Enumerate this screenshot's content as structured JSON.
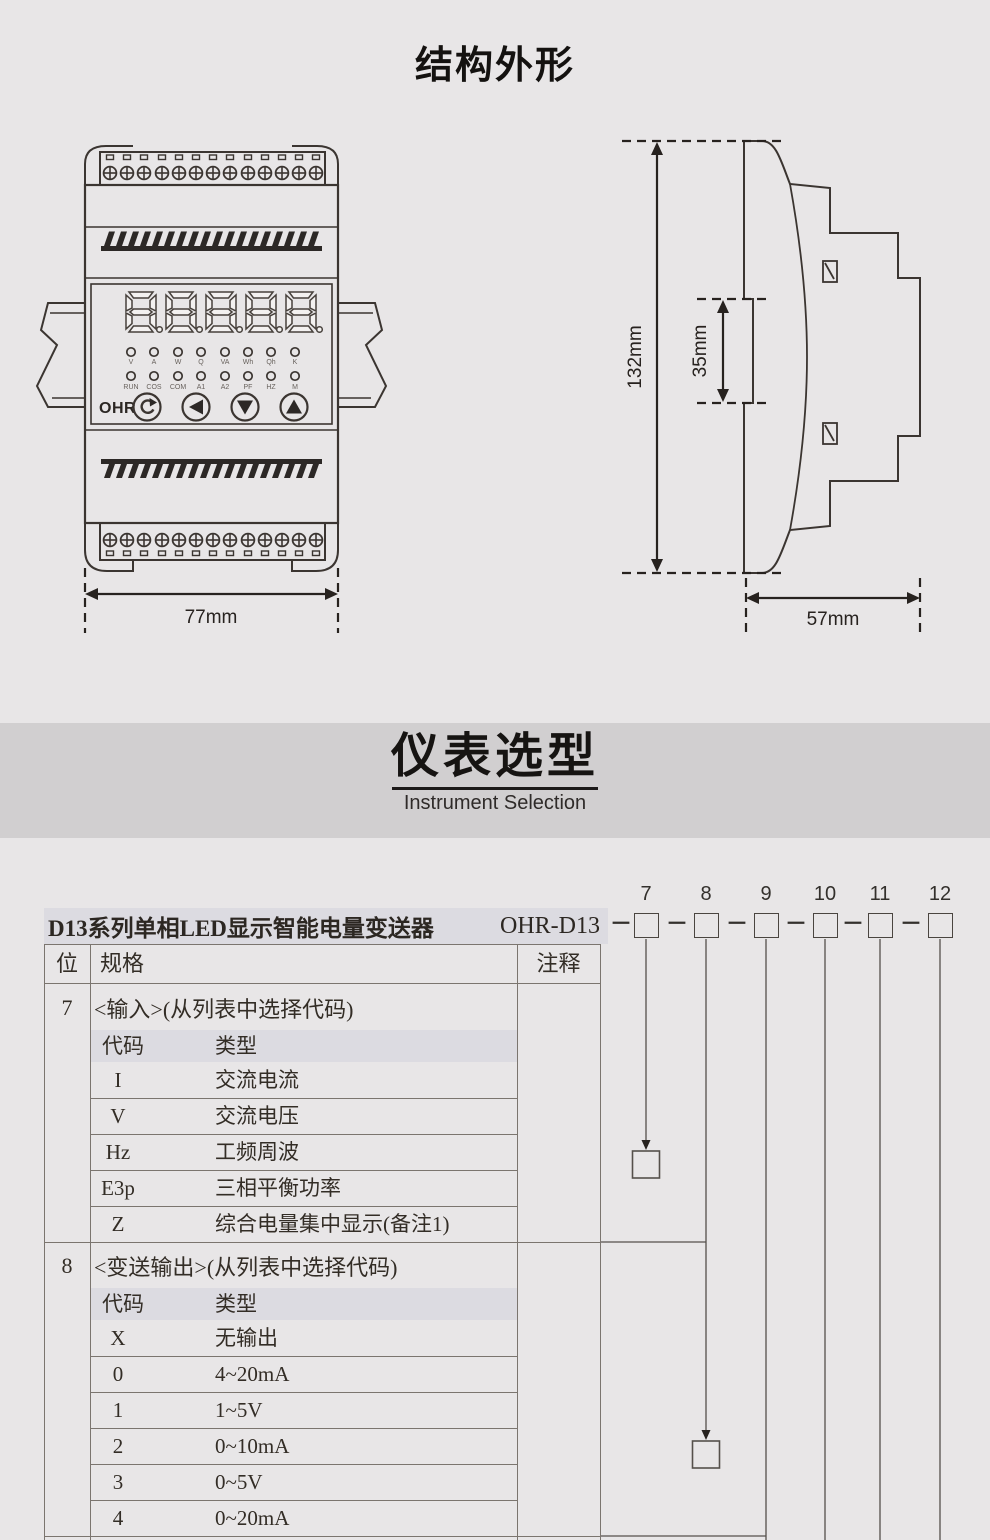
{
  "section_structure": {
    "title": "结构外形"
  },
  "front_view": {
    "logo": "OHR",
    "display": "8.8.8.8.8.",
    "led_row1": [
      "V",
      "A",
      "W",
      "Q",
      "VA",
      "Wh",
      "Qh",
      "K"
    ],
    "led_row2": [
      "RUN",
      "COS",
      "COM",
      "A1",
      "A2",
      "PF",
      "HZ",
      "M"
    ],
    "dim_width": "77mm"
  },
  "side_view": {
    "dim_height": "132mm",
    "dim_rail": "35mm",
    "dim_depth": "57mm"
  },
  "section_selection": {
    "title": "仪表选型",
    "subtitle": "Instrument Selection"
  },
  "ordering": {
    "product_title": "D13系列单相LED显示智能电量变送器",
    "model_prefix": "OHR-D13",
    "separator": "－",
    "positions": [
      "7",
      "8",
      "9",
      "10",
      "11",
      "12"
    ],
    "table": {
      "col_pos": "位",
      "col_spec": "规格",
      "col_note": "注释",
      "sections": [
        {
          "pos": "7",
          "label": "<输入>(从列表中选择代码)",
          "code_header": "代码",
          "type_header": "类型",
          "rows": [
            {
              "code": "I",
              "type": "交流电流"
            },
            {
              "code": "V",
              "type": "交流电压"
            },
            {
              "code": "Hz",
              "type": "工频周波"
            },
            {
              "code": "E3p",
              "type": "三相平衡功率"
            },
            {
              "code": "Z",
              "type": "综合电量集中显示(备注1)"
            }
          ]
        },
        {
          "pos": "8",
          "label": "<变送输出>(从列表中选择代码)",
          "code_header": "代码",
          "type_header": "类型",
          "rows": [
            {
              "code": "X",
              "type": "无输出"
            },
            {
              "code": "0",
              "type": "4~20mA"
            },
            {
              "code": "1",
              "type": "1~5V"
            },
            {
              "code": "2",
              "type": "0~10mA"
            },
            {
              "code": "3",
              "type": "0~5V"
            },
            {
              "code": "4",
              "type": "0~20mA"
            }
          ]
        }
      ]
    }
  }
}
